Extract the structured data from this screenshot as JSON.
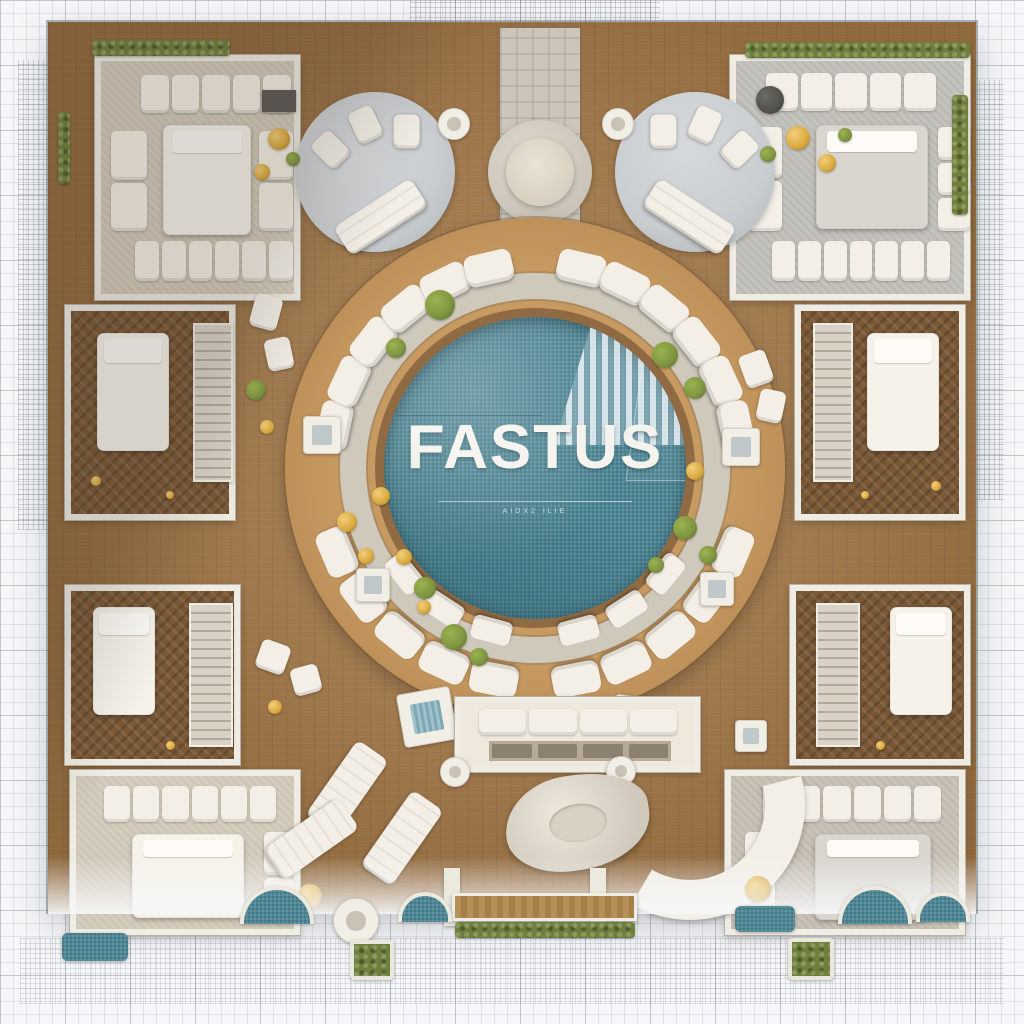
{
  "scene": {
    "brand": {
      "title": "FASTUS",
      "tagline": "AIDX2 ILIE"
    },
    "colors": {
      "blueprint-paper": "#f6f7f8",
      "blueprint-line": "#aab2ba",
      "plaza-wood": "#a87a47",
      "deck-wood": "#bd8f58",
      "stone-ring": "#cfc9bc",
      "pool-teal": "#4e8896",
      "pool-rim": "#8f6a43",
      "cushion-white": "#f3efe6",
      "wall-white": "#efece4",
      "wall-edge": "#b7b1a6",
      "carpet-beige": "#d4ccbc",
      "carpet-gray": "#c4c2bc",
      "herringbone-brown": "#7a5836",
      "marble-gray": "#c9cdd0",
      "hedge-green": "#6f7f3c",
      "shrub-green": "#7e9440",
      "accent-gold": "#d9a93e"
    }
  }
}
